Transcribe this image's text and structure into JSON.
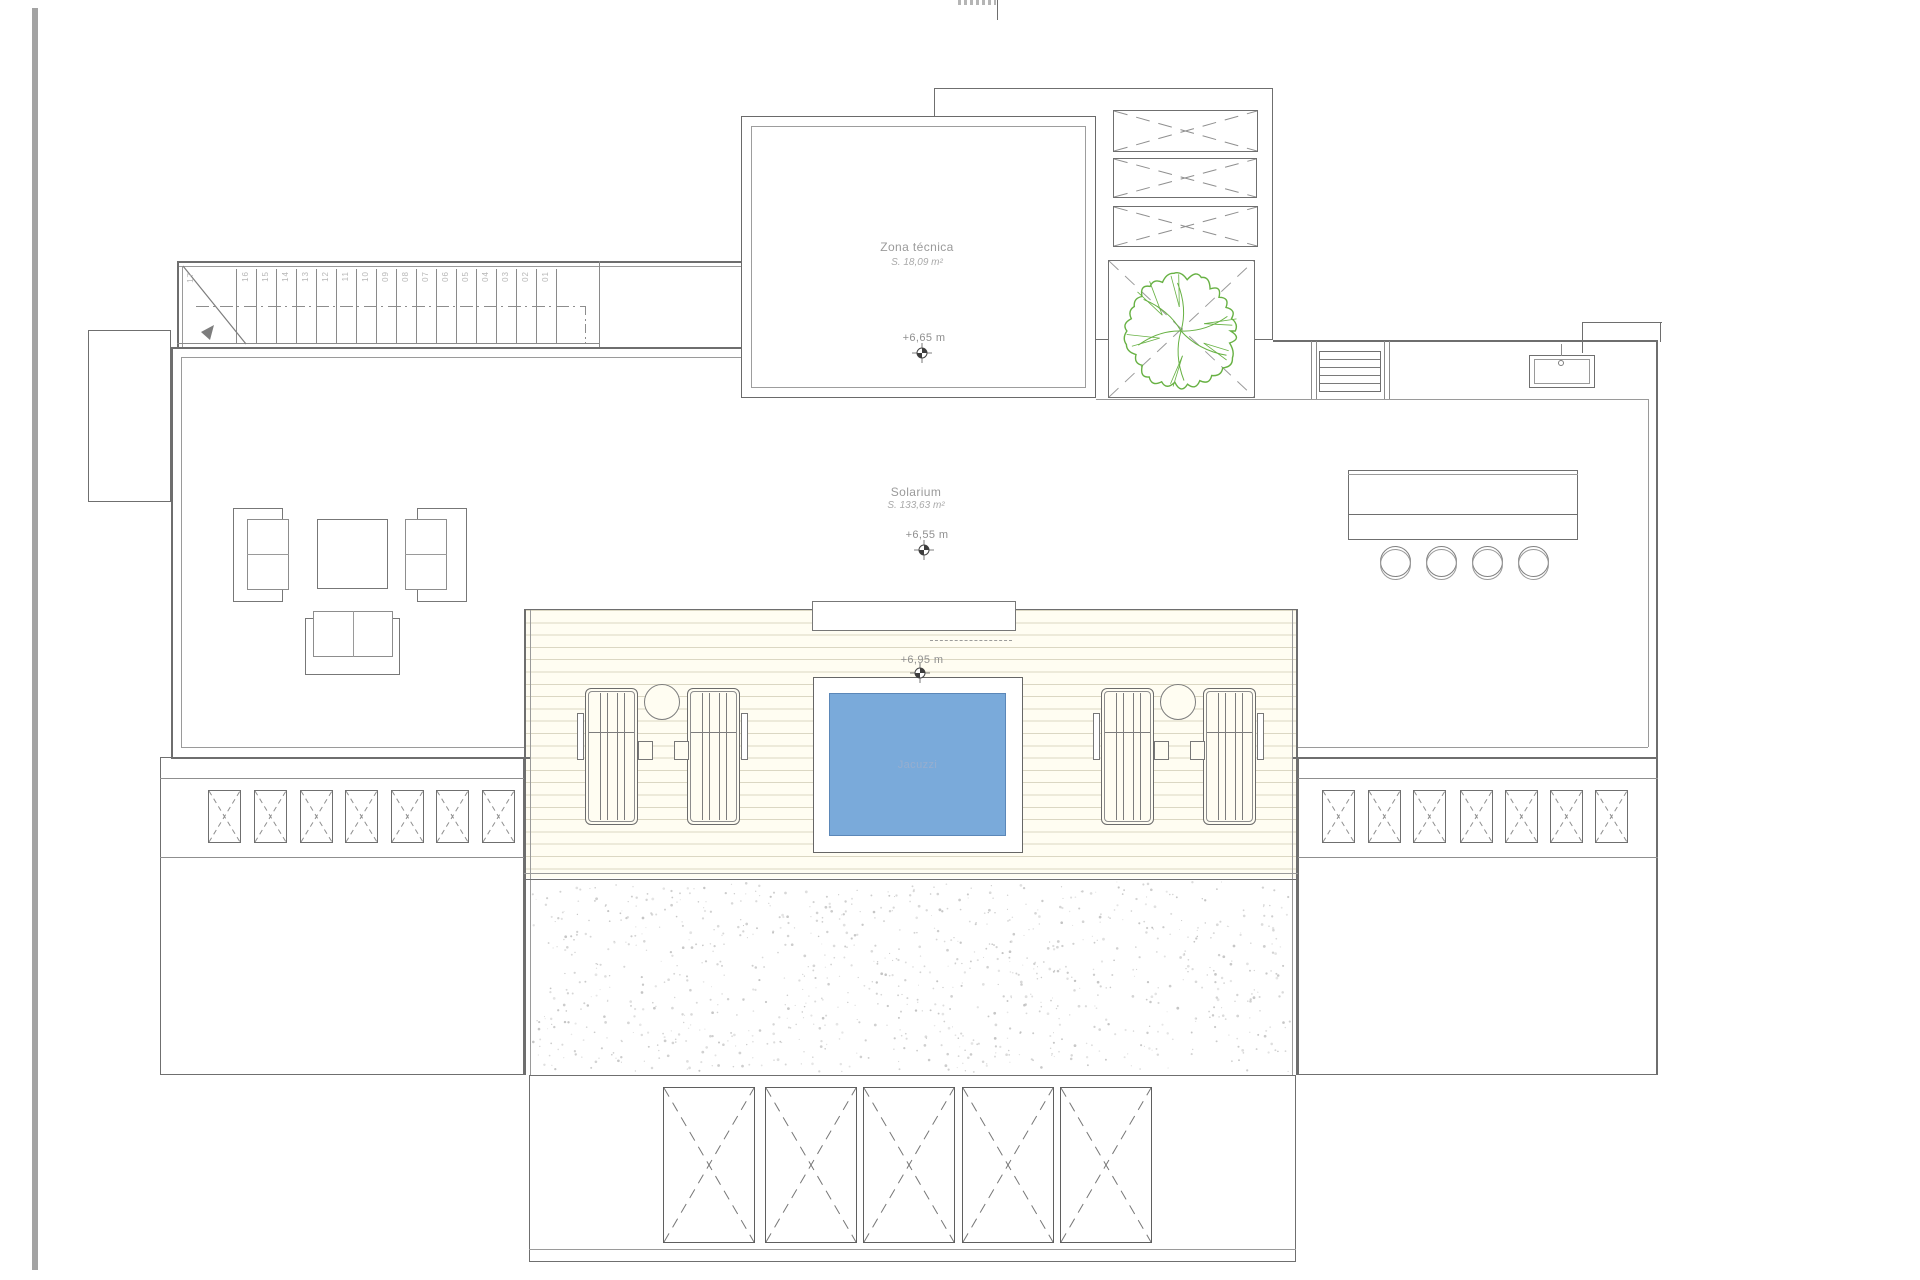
{
  "drawing": {
    "rooms": [
      {
        "name": "Zona técnica",
        "area": "S. 18,09 m²",
        "level": "+6,65 m"
      },
      {
        "name": "Solarium",
        "area": "S. 133,63 m²",
        "level": "+6,55 m"
      }
    ],
    "deck": {
      "level": "+6,95 m",
      "jacuzzi_label": "Jacuzzi"
    },
    "stairs": {
      "top_number": "17",
      "numbers": [
        "16",
        "15",
        "14",
        "13",
        "12",
        "11",
        "10",
        "09",
        "08",
        "07",
        "06",
        "05",
        "04",
        "03",
        "02",
        "01"
      ]
    },
    "colors": {
      "jacuzzi_fill": "#7aaada",
      "jacuzzi_edge": "#5b87b8",
      "tree_green": "#67b143",
      "deck_bg": "#fffdf2",
      "deck_line": "#dbd7c3",
      "wall_line": "#6e6e6e",
      "edge_rule": "#a3a3a3",
      "stipple": "#b9b9b9"
    }
  }
}
